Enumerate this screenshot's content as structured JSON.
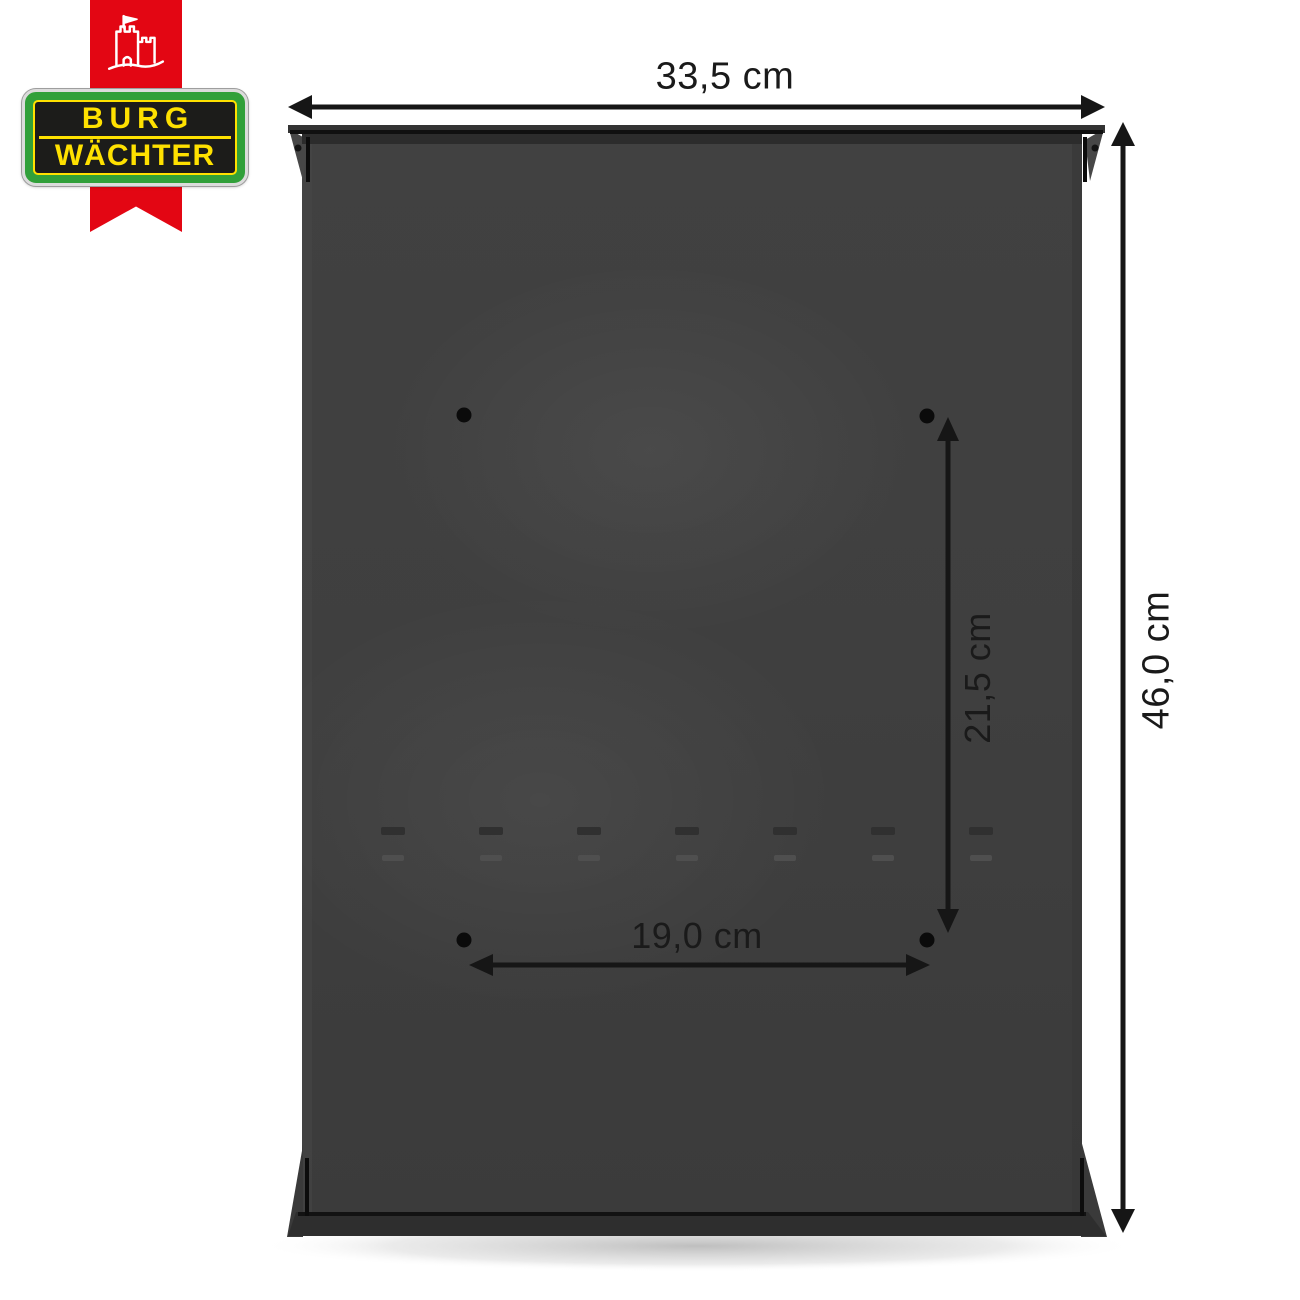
{
  "brand": {
    "badge": {
      "line1": "BURG",
      "line2": "WÄCHTER"
    },
    "castle_icon": "castle-icon",
    "colors": {
      "ribbon_red": "#e30613",
      "badge_green": "#31a03a",
      "badge_yellow": "#ffe100",
      "badge_black": "#1c1c1a"
    }
  },
  "product": {
    "body_color": "#3f3f3f",
    "mounting_holes": 4
  },
  "annotations": {
    "overall_width": "33,5 cm",
    "overall_height": "46,0 cm",
    "mounting_hole_spacing_vertical": "21,5 cm",
    "mounting_hole_spacing_horizontal": "19,0 cm"
  }
}
